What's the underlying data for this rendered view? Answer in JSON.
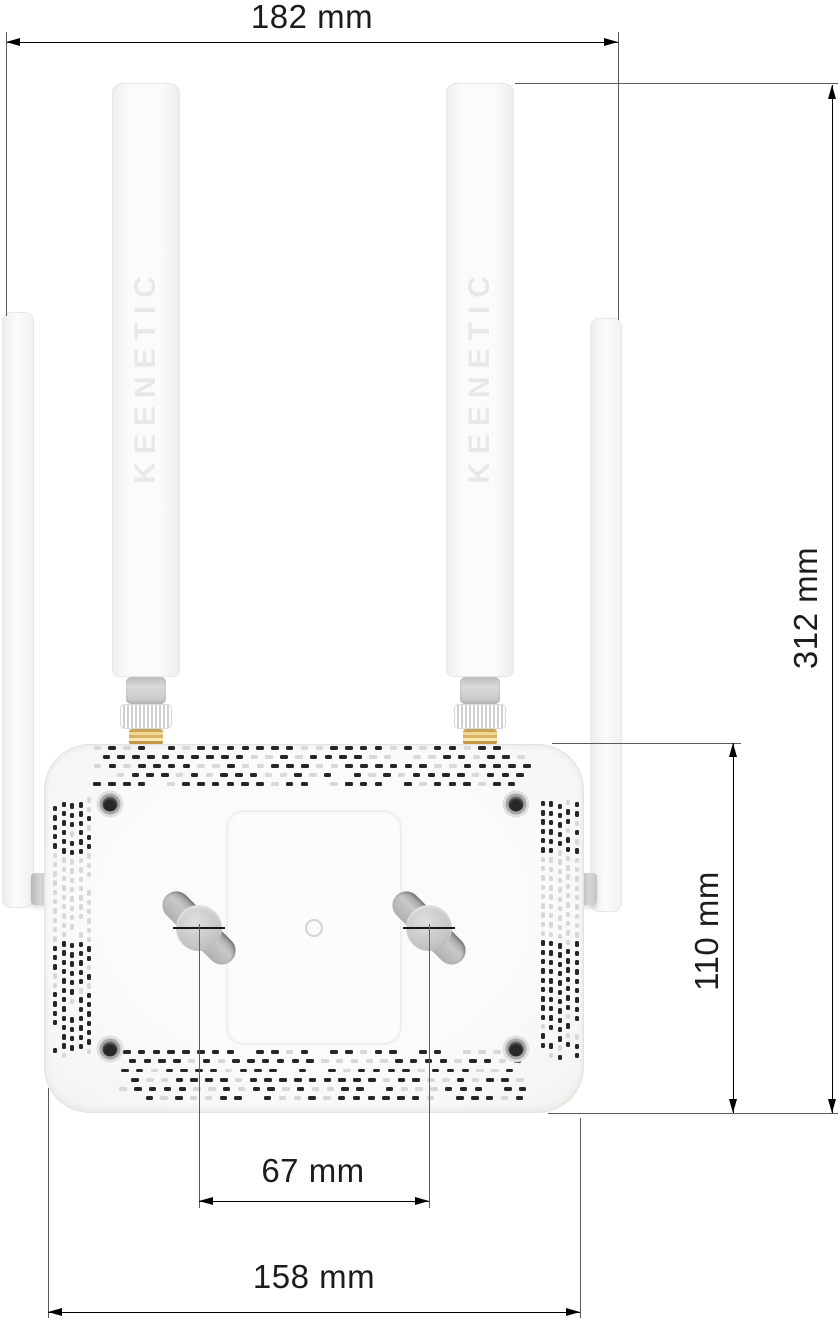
{
  "figure": {
    "type": "technical-drawing",
    "subject": "Wi-Fi router bottom view with four external antennas and wall-mount keyholes",
    "brand_label": "KEENETIC",
    "dimensions": {
      "top_width": "182 mm",
      "overall_height": "312 mm",
      "body_height": "110 mm",
      "mount_hole_spacing": "67 mm",
      "body_width": "158 mm"
    },
    "colors": {
      "background": "#ffffff",
      "device_body": "#fafaf9",
      "device_edge": "#e2e2df",
      "vent_dark": "#262626",
      "vent_light": "#d8d8d6",
      "connector_gray": "#cdcdcb",
      "connector_brass": "#e3bc67",
      "dimension_line": "#000000",
      "extension_line": "#5c5c5c",
      "text": "#1c1c1c",
      "emboss_text": "#e8e8e6"
    }
  }
}
